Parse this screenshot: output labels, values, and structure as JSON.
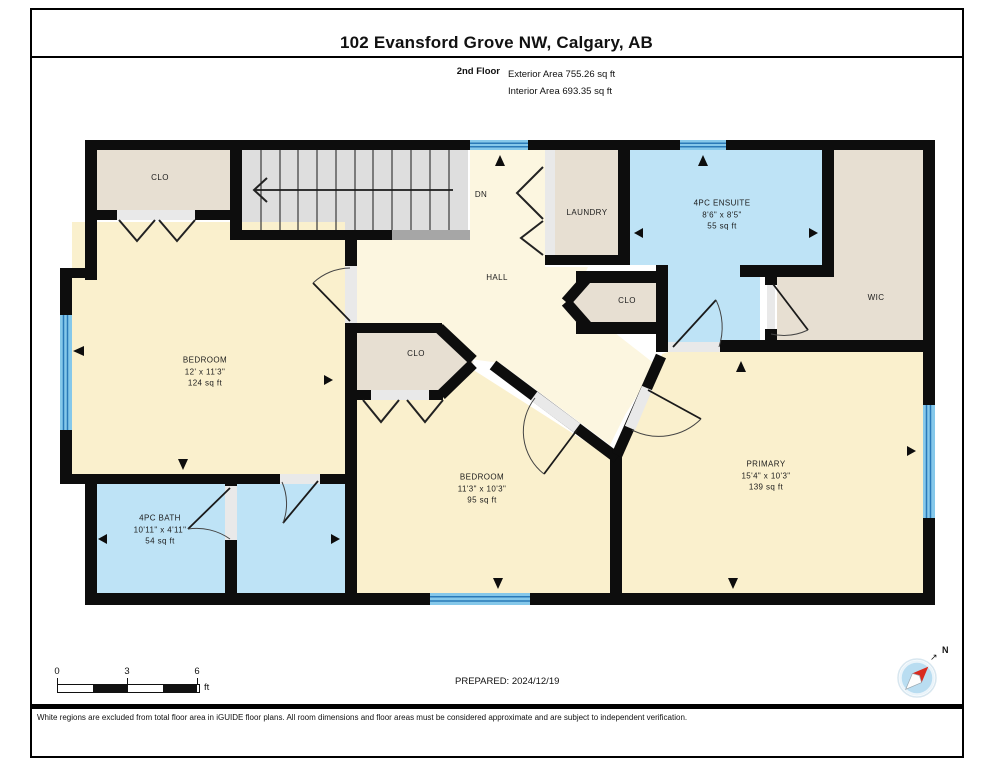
{
  "header": {
    "title": "102 Evansford Grove NW, Calgary, AB",
    "floor_label": "2nd Floor",
    "exterior_area": "Exterior Area 755.26 sq ft",
    "interior_area": "Interior Area 693.35 sq ft"
  },
  "rooms": {
    "clo_nw": {
      "name": "CLO"
    },
    "stairs": {
      "direction_label": "DN"
    },
    "hall": {
      "name": "HALL"
    },
    "laundry": {
      "name": "LAUNDRY"
    },
    "ensuite": {
      "name": "4PC ENSUITE",
      "dims": "8'6\" x 8'5\"",
      "area": "55 sq ft"
    },
    "clo_ensuite": {
      "name": "CLO"
    },
    "wic": {
      "name": "WIC"
    },
    "bedroom_west": {
      "name": "BEDROOM",
      "dims": "12' x 11'3\"",
      "area": "124 sq ft"
    },
    "clo_hall": {
      "name": "CLO"
    },
    "bedroom_south": {
      "name": "BEDROOM",
      "dims": "11'3\" x 10'3\"",
      "area": "95 sq ft"
    },
    "primary": {
      "name": "PRIMARY",
      "dims": "15'4\" x 10'3\"",
      "area": "139 sq ft"
    },
    "bath": {
      "name": "4PC BATH",
      "dims": "10'11\" x 4'11\"",
      "area": "54 sq ft"
    }
  },
  "scale_bar": {
    "ticks": [
      "0",
      "3",
      "6"
    ],
    "unit": "ft"
  },
  "prepared": "PREPARED: 2024/12/19",
  "compass": {
    "north_label": "N",
    "north_arrow": "↗"
  },
  "footer": "White regions are excluded from total floor area in iGUIDE floor plans. All room dimensions and floor areas must be considered approximate and are subject to independent verification.",
  "colors": {
    "room": "#faf0cd",
    "hall": "#fcf6e0",
    "closet": "#e7dfd2",
    "wet": "#bee3f6",
    "stairs": "#dedede",
    "window_light": "#85c8ea",
    "window_dark": "#2a7ab8",
    "wall": "#0d0d0d"
  }
}
